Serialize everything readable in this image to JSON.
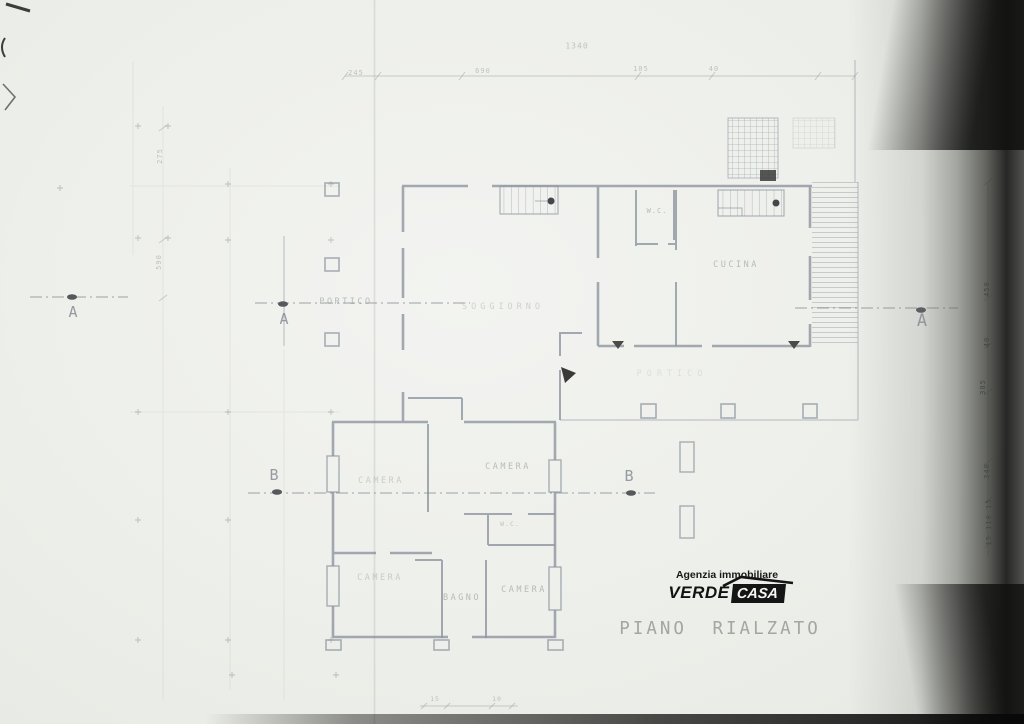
{
  "document": {
    "plan_title": "PIANO RIALZATO"
  },
  "logo": {
    "tagline": "Agenzia immobiliare",
    "brand_word1": "VERDE",
    "brand_word2": "CASA"
  },
  "rooms": {
    "portico": "PORTICO",
    "soggiorno": "SOGGIORNO",
    "wc_upper": "W.C.",
    "cucina": "CUCINA",
    "camera_left": "CAMERA",
    "camera_center": "CAMERA",
    "wc_lower": "W.C.",
    "camera_bottom_left": "CAMERA",
    "bagno": "BAGNO",
    "camera_bottom_center": "CAMERA",
    "portico_rear": "PORTICO"
  },
  "markers": {
    "section_a": "A",
    "section_b": "B"
  },
  "dimensions": {
    "top": [
      "245",
      "690",
      "1340",
      "105",
      "40"
    ],
    "left": [
      "275",
      "590"
    ],
    "right": [
      "450",
      "40",
      "305",
      "340",
      "15 110 15"
    ],
    "bottom": [
      "15",
      "10"
    ]
  },
  "colors": {
    "paper": "#eef0ec",
    "ink": "#8e95a0",
    "label_gray": "#a9afa9",
    "logo_black": "#151515",
    "shadow_black": "#1a1a18"
  }
}
